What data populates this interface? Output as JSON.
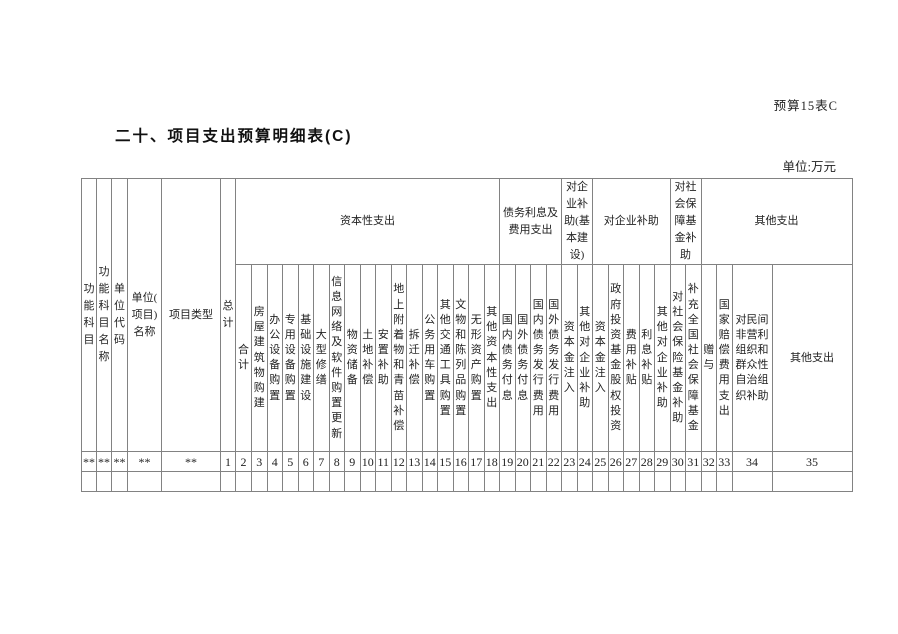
{
  "page": {
    "sheet_label": "预算15表C",
    "title": "二十、项目支出预算明细表(C)",
    "unit_label": "单位:万元"
  },
  "table": {
    "full_height_headers": [
      "功能科目",
      "功能科目名称",
      "单位代码",
      "单位(项目)名称",
      "项目类型",
      "总计"
    ],
    "group_headers": [
      "资本性支出",
      "债务利息及费用支出",
      "对企业补助(基本建设)",
      "对企业补助",
      "对社会保障基金补助",
      "其他支出"
    ],
    "sub_headers": [
      "合计",
      "房屋建筑物购建",
      "办公设备购置",
      "专用设备购置",
      "基础设施建设",
      "大型修缮",
      "信息网络及软件购置更新",
      "物资储备",
      "土地补偿",
      "安置补助",
      "地上附着物和青苗补偿",
      "拆迁补偿",
      "公务用车购置",
      "其他交通工具购置",
      "文物和陈列品购置",
      "无形资产购置",
      "其他资本性支出",
      "国内债务付息",
      "国外债务付息",
      "国内债务发行费用",
      "国外债务发行费用",
      "资本金注入",
      "其他对企业补助",
      "资本金注入",
      "政府投资基金股权投资",
      "费用补贴",
      "利息补贴",
      "其他对企业补助",
      "对社会保险基金补助",
      "补充全国社会保障基金",
      "赠与",
      "国家赔偿费用支出",
      "对民间非营利组织和群众性自治组织补助",
      "其他支出"
    ],
    "code_row": [
      "**",
      "**",
      "**",
      "**",
      "**",
      "1",
      "2",
      "3",
      "4",
      "5",
      "6",
      "7",
      "8",
      "9",
      "10",
      "11",
      "12",
      "13",
      "14",
      "15",
      "16",
      "17",
      "18",
      "19",
      "20",
      "21",
      "22",
      "23",
      "24",
      "25",
      "26",
      "27",
      "28",
      "29",
      "30",
      "31",
      "32",
      "33",
      "34",
      "35"
    ],
    "colors": {
      "border": "#828282",
      "text": "#222222"
    }
  }
}
